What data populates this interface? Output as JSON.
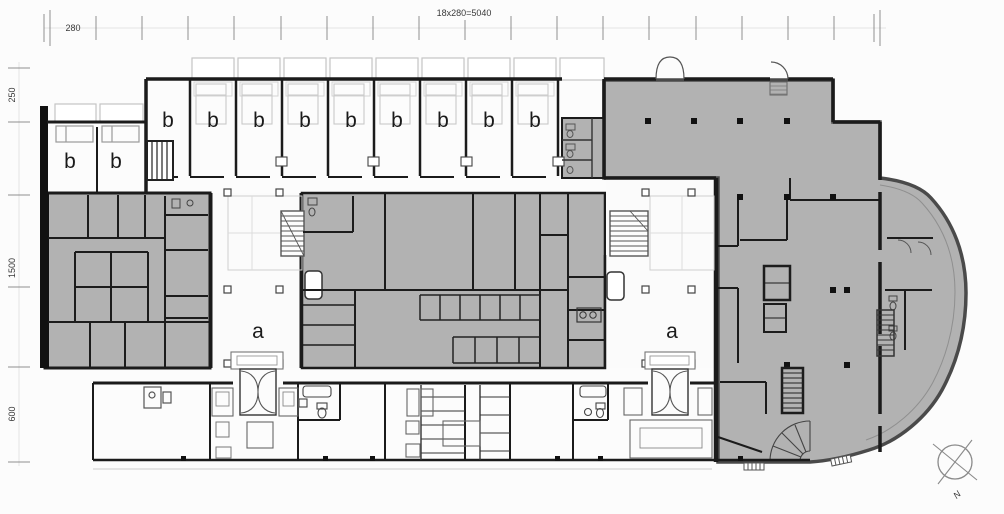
{
  "document": {
    "type": "architectural-floor-plan"
  },
  "dimensions": {
    "top_total": "18x280=5040",
    "top_module": "280",
    "left": [
      "250",
      "1500",
      "600"
    ]
  },
  "labels": {
    "room_a": "a",
    "room_b": "b",
    "north": "N"
  },
  "rooms": {
    "a_count": 2,
    "b_count": 11
  },
  "colors": {
    "background": "#fcfcfc",
    "room_fill": "#b2b2b2",
    "wall": "#1b1b1b",
    "outer_facade": "#4a4a4a",
    "balcony_outline": "#c4c4c4",
    "thin_line": "#555555",
    "dimension_line": "#8f8f8f",
    "text": "#333333"
  }
}
